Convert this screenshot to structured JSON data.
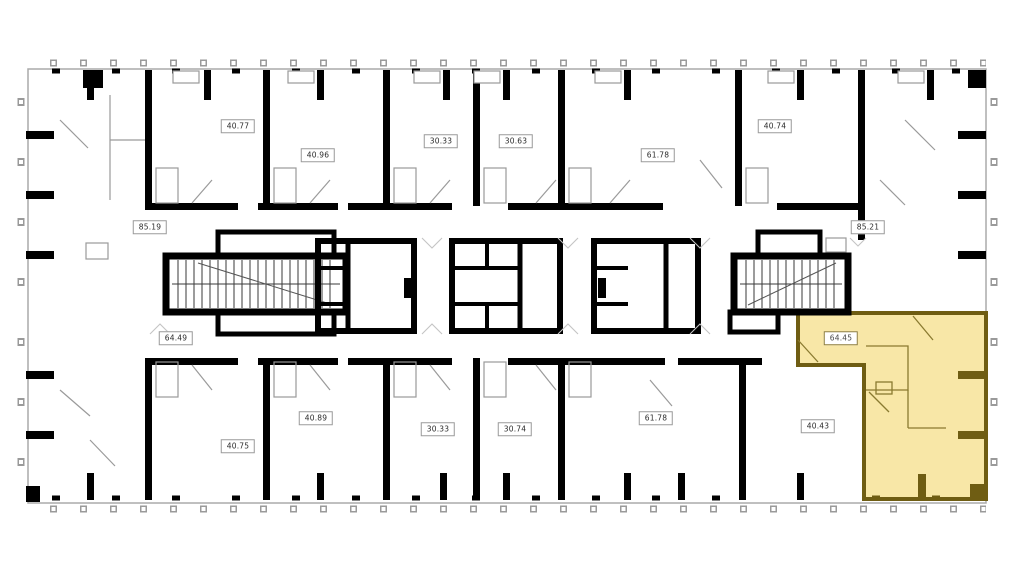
{
  "plan": {
    "title": "floor-plan",
    "wall_color": "#000000",
    "partition_color": "#999999",
    "highlight": {
      "fill": "#f8e6a2",
      "border": "#6f5d13",
      "selected_unit_label": "64.45"
    },
    "units": [
      {
        "id": "unit-40-77-top",
        "label": "40.77",
        "highlighted": false
      },
      {
        "id": "unit-40-96-top",
        "label": "40.96",
        "highlighted": false
      },
      {
        "id": "unit-30-33-top",
        "label": "30.33",
        "highlighted": false
      },
      {
        "id": "unit-30-63-top",
        "label": "30.63",
        "highlighted": false
      },
      {
        "id": "unit-61-78-top",
        "label": "61.78",
        "highlighted": false
      },
      {
        "id": "unit-40-74-top",
        "label": "40.74",
        "highlighted": false
      },
      {
        "id": "unit-85-19-left",
        "label": "85.19",
        "highlighted": false
      },
      {
        "id": "unit-85-21-right",
        "label": "85.21",
        "highlighted": false
      },
      {
        "id": "unit-64-49-left",
        "label": "64.49",
        "highlighted": false
      },
      {
        "id": "unit-64-45-selected",
        "label": "64.45",
        "highlighted": true
      },
      {
        "id": "unit-40-75-bottom",
        "label": "40.75",
        "highlighted": false
      },
      {
        "id": "unit-40-89-bottom",
        "label": "40.89",
        "highlighted": false
      },
      {
        "id": "unit-30-33-bottom",
        "label": "30.33",
        "highlighted": false
      },
      {
        "id": "unit-30-74-bottom",
        "label": "30.74",
        "highlighted": false
      },
      {
        "id": "unit-61-78-bottom",
        "label": "61.78",
        "highlighted": false
      },
      {
        "id": "unit-40-43-bottom",
        "label": "40.43",
        "highlighted": false
      }
    ]
  }
}
